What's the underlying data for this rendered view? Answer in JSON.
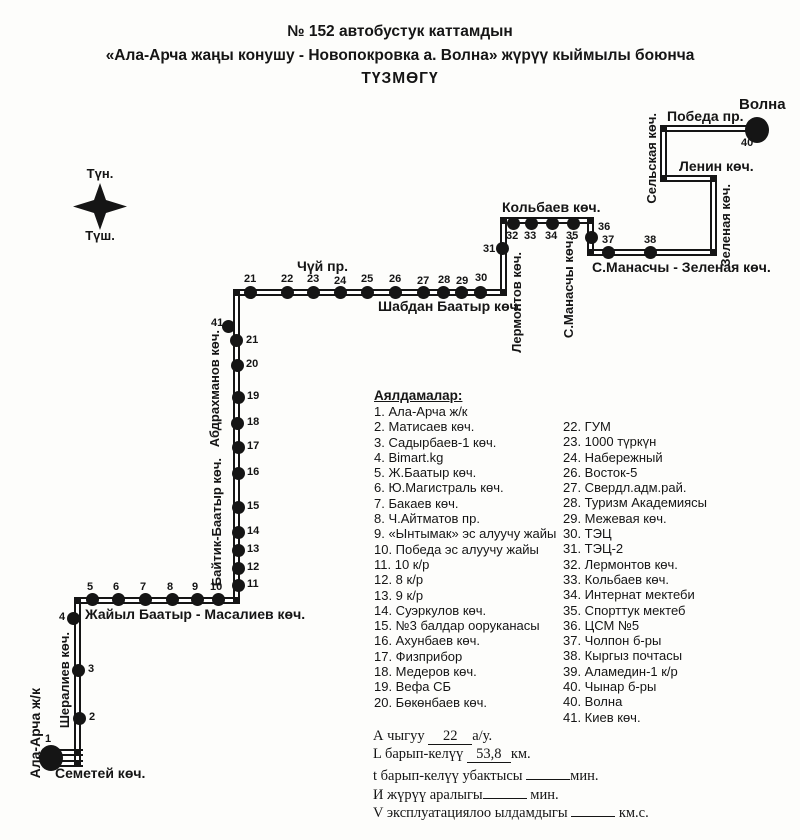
{
  "title": {
    "line1": "№ 152  автобустук каттамдын",
    "line2": "«Ала-Арча жаңы конушу  - Новопокровка а. Волна»  жүрүү кыймылы боюнча",
    "line3": "ТҮЗМӨГҮ"
  },
  "compass": {
    "north": "Түн.",
    "south": "Түш."
  },
  "map": {
    "segments": [
      {
        "o": "h",
        "x": 51,
        "y": 752,
        "len": 32
      },
      {
        "o": "h",
        "x": 51,
        "y": 763,
        "len": 32
      },
      {
        "o": "v",
        "x": 77,
        "y": 600,
        "len": 166
      },
      {
        "o": "h",
        "x": 74,
        "y": 600,
        "len": 165
      },
      {
        "o": "v",
        "x": 236,
        "y": 292,
        "len": 311
      },
      {
        "o": "h",
        "x": 233,
        "y": 292,
        "len": 273
      },
      {
        "o": "v",
        "x": 503,
        "y": 220,
        "len": 75
      },
      {
        "o": "h",
        "x": 500,
        "y": 220,
        "len": 93
      },
      {
        "o": "v",
        "x": 590,
        "y": 217,
        "len": 38
      },
      {
        "o": "h",
        "x": 587,
        "y": 252,
        "len": 129
      },
      {
        "o": "v",
        "x": 713,
        "y": 175,
        "len": 80
      },
      {
        "o": "h",
        "x": 660,
        "y": 178,
        "len": 56
      },
      {
        "o": "v",
        "x": 663,
        "y": 125,
        "len": 56
      },
      {
        "o": "h",
        "x": 660,
        "y": 128,
        "len": 92
      }
    ],
    "joints": [
      [
        77,
        600
      ],
      [
        236,
        600
      ],
      [
        236,
        292
      ],
      [
        503,
        292
      ],
      [
        503,
        220
      ],
      [
        590,
        220
      ],
      [
        590,
        252
      ],
      [
        713,
        252
      ],
      [
        713,
        178
      ],
      [
        663,
        178
      ],
      [
        663,
        128
      ],
      [
        77,
        752
      ],
      [
        77,
        763
      ]
    ],
    "stops": [
      {
        "n": "1",
        "dx": 51,
        "dy": 758,
        "big": 1,
        "lx": 45,
        "ly": 733
      },
      {
        "n": "2",
        "dx": 79,
        "dy": 718,
        "lx": 89,
        "ly": 711
      },
      {
        "n": "3",
        "dx": 78,
        "dy": 670,
        "lx": 88,
        "ly": 663
      },
      {
        "n": "4",
        "dx": 73,
        "dy": 618,
        "lx": 59,
        "ly": 611
      },
      {
        "n": "5",
        "dx": 92,
        "dy": 599,
        "lx": 87,
        "ly": 581
      },
      {
        "n": "6",
        "dx": 118,
        "dy": 599,
        "lx": 113,
        "ly": 581
      },
      {
        "n": "7",
        "dx": 145,
        "dy": 599,
        "lx": 140,
        "ly": 581
      },
      {
        "n": "8",
        "dx": 172,
        "dy": 599,
        "lx": 167,
        "ly": 581
      },
      {
        "n": "9",
        "dx": 197,
        "dy": 599,
        "lx": 192,
        "ly": 581
      },
      {
        "n": "10",
        "dx": 218,
        "dy": 599,
        "lx": 210,
        "ly": 581
      },
      {
        "n": "11",
        "dx": 238,
        "dy": 585,
        "lx": 247,
        "ly": 578
      },
      {
        "n": "12",
        "dx": 238,
        "dy": 568,
        "lx": 247,
        "ly": 561
      },
      {
        "n": "13",
        "dx": 238,
        "dy": 550,
        "lx": 247,
        "ly": 543
      },
      {
        "n": "14",
        "dx": 238,
        "dy": 532,
        "lx": 247,
        "ly": 525
      },
      {
        "n": "15",
        "dx": 238,
        "dy": 507,
        "lx": 247,
        "ly": 500
      },
      {
        "n": "16",
        "dx": 238,
        "dy": 473,
        "lx": 247,
        "ly": 466
      },
      {
        "n": "17",
        "dx": 238,
        "dy": 447,
        "lx": 247,
        "ly": 440
      },
      {
        "n": "18",
        "dx": 237,
        "dy": 423,
        "lx": 247,
        "ly": 416
      },
      {
        "n": "19",
        "dx": 238,
        "dy": 397,
        "lx": 247,
        "ly": 390
      },
      {
        "n": "20",
        "dx": 237,
        "dy": 365,
        "lx": 246,
        "ly": 358
      },
      {
        "n": "41",
        "dx": 228,
        "dy": 326,
        "lx": 211,
        "ly": 317
      },
      {
        "n": "21",
        "dx": 236,
        "dy": 340,
        "lx": 246,
        "ly": 334
      },
      {
        "n": "21",
        "dx": 250,
        "dy": 292,
        "lx": 244,
        "ly": 273
      },
      {
        "n": "22",
        "dx": 287,
        "dy": 292,
        "lx": 281,
        "ly": 273
      },
      {
        "n": "23",
        "dx": 313,
        "dy": 292,
        "lx": 307,
        "ly": 273
      },
      {
        "n": "24",
        "dx": 340,
        "dy": 292,
        "lx": 334,
        "ly": 275
      },
      {
        "n": "25",
        "dx": 367,
        "dy": 292,
        "lx": 361,
        "ly": 273
      },
      {
        "n": "26",
        "dx": 395,
        "dy": 292,
        "lx": 389,
        "ly": 273
      },
      {
        "n": "27",
        "dx": 423,
        "dy": 292,
        "lx": 417,
        "ly": 275
      },
      {
        "n": "28",
        "dx": 443,
        "dy": 292,
        "lx": 438,
        "ly": 274
      },
      {
        "n": "29",
        "dx": 461,
        "dy": 292,
        "lx": 456,
        "ly": 275
      },
      {
        "n": "30",
        "dx": 480,
        "dy": 292,
        "lx": 475,
        "ly": 272
      },
      {
        "n": "31",
        "dx": 502,
        "dy": 248,
        "lx": 483,
        "ly": 243
      },
      {
        "n": "32",
        "dx": 513,
        "dy": 223,
        "lx": 506,
        "ly": 230
      },
      {
        "n": "33",
        "dx": 531,
        "dy": 223,
        "lx": 524,
        "ly": 230
      },
      {
        "n": "34",
        "dx": 552,
        "dy": 223,
        "lx": 545,
        "ly": 230
      },
      {
        "n": "35",
        "dx": 573,
        "dy": 223,
        "lx": 566,
        "ly": 230
      },
      {
        "n": "36",
        "dx": 591,
        "dy": 237,
        "lx": 598,
        "ly": 221
      },
      {
        "n": "37",
        "dx": 608,
        "dy": 252,
        "lx": 602,
        "ly": 234
      },
      {
        "n": "38",
        "dx": 650,
        "dy": 252,
        "lx": 644,
        "ly": 234
      },
      {
        "n": "40",
        "dx": 757,
        "dy": 130,
        "big": 1,
        "lx": 741,
        "ly": 137
      }
    ],
    "labels": [
      {
        "t": "Семетей көч.",
        "x": 55,
        "y": 766,
        "fs": 14
      },
      {
        "t": "Ала-Арча ж/к",
        "x": 28,
        "y": 688,
        "v": 1,
        "fs": 14
      },
      {
        "t": "Шералиев көч.",
        "x": 58,
        "y": 632,
        "v": 1,
        "fs": 13
      },
      {
        "t": "Жайыл Баатыр -  Масалиев көч.",
        "x": 85,
        "y": 607,
        "fs": 14
      },
      {
        "t": "Байтик-Баатыр көч.",
        "x": 210,
        "y": 458,
        "v": 1,
        "fs": 13
      },
      {
        "t": "Абдрахманов көч.",
        "x": 208,
        "y": 330,
        "v": 1,
        "fs": 13
      },
      {
        "t": "Чүй пр.",
        "x": 297,
        "y": 259,
        "fs": 14
      },
      {
        "t": "Шабдан Баатыр көч.",
        "x": 378,
        "y": 299,
        "fs": 14
      },
      {
        "t": "Лермонтов көч.",
        "x": 510,
        "y": 252,
        "v": 1,
        "fs": 13
      },
      {
        "t": "Кольбаев көч.",
        "x": 502,
        "y": 200,
        "fs": 14
      },
      {
        "t": "С.Манасчы көч.",
        "x": 562,
        "y": 237,
        "v": 1,
        "fs": 13
      },
      {
        "t": "С.Манасчы - Зеленая көч.",
        "x": 592,
        "y": 260,
        "fs": 14
      },
      {
        "t": "Зеленая көч.",
        "x": 719,
        "y": 184,
        "v": 1,
        "fs": 13
      },
      {
        "t": "Ленин көч.",
        "x": 679,
        "y": 159,
        "fs": 14
      },
      {
        "t": "Сельская көч.",
        "x": 645,
        "y": 113,
        "v": 1,
        "fs": 13
      },
      {
        "t": "Победа пр.",
        "x": 667,
        "y": 109,
        "fs": 14
      },
      {
        "t": "Волна",
        "x": 739,
        "y": 97,
        "fs": 15
      }
    ]
  },
  "legend": {
    "title": "Аялдамалар:",
    "left": [
      "1. Ала-Арча ж/к",
      "2. Матисаев көч.",
      "3. Садырбаев-1 көч.",
      "4.  Bimart.kg",
      "5. Ж.Баатыр көч.",
      "6. Ю.Магистраль көч.",
      "7. Бакаев көч.",
      "8. Ч.Айтматов пр.",
      "9. «Ынтымак» эс алуучу жайы",
      "10. Победа эс алуучу жайы",
      "11. 10 к/р",
      "12. 8 к/р",
      "13. 9 к/р",
      "14. Суэркулов көч.",
      "15. №3 балдар ооруканасы",
      "16. Ахунбаев көч.",
      "17. Физприбор",
      "18. Медеров көч.",
      "19. Вефа СБ",
      "20. Бөкөнбаев көч."
    ],
    "right": [
      "22. ГУМ",
      "23. 1000 түркүн",
      "24. Набережный",
      "26. Восток-5",
      "27. Свердл.адм.рай.",
      "28. Туризм Академиясы",
      "29. Межевая көч.",
      "30. ТЭЦ",
      "31. ТЭЦ-2",
      "32. Лермонтов көч.",
      "33. Кольбаев көч.",
      "34. Интернат мектеби",
      "35. Спорттук мектеб",
      "36. ЦСМ №5",
      "37. Чолпон б-ры",
      "38. Кыргыз почтасы",
      "39. Аламедин-1 к/р",
      "40. Чынар б-ры",
      "40. Волна",
      "41. Киев көч."
    ]
  },
  "stats": {
    "lines": [
      {
        "pre": "А чыгуу ",
        "value": "22",
        "post": "а/у."
      },
      {
        "pre": "L барып-келүү ",
        "value": "53,8",
        "post": "км."
      },
      {
        "pre": "t барып-келүү убактысы ",
        "value": "",
        "post": "мин."
      },
      {
        "pre": "И жүрүү аралыгы",
        "value": "",
        "post": " мин."
      },
      {
        "pre": "V эксплуатациялоо ылдамдыгы ",
        "value": "",
        "post": " км.с."
      }
    ]
  }
}
